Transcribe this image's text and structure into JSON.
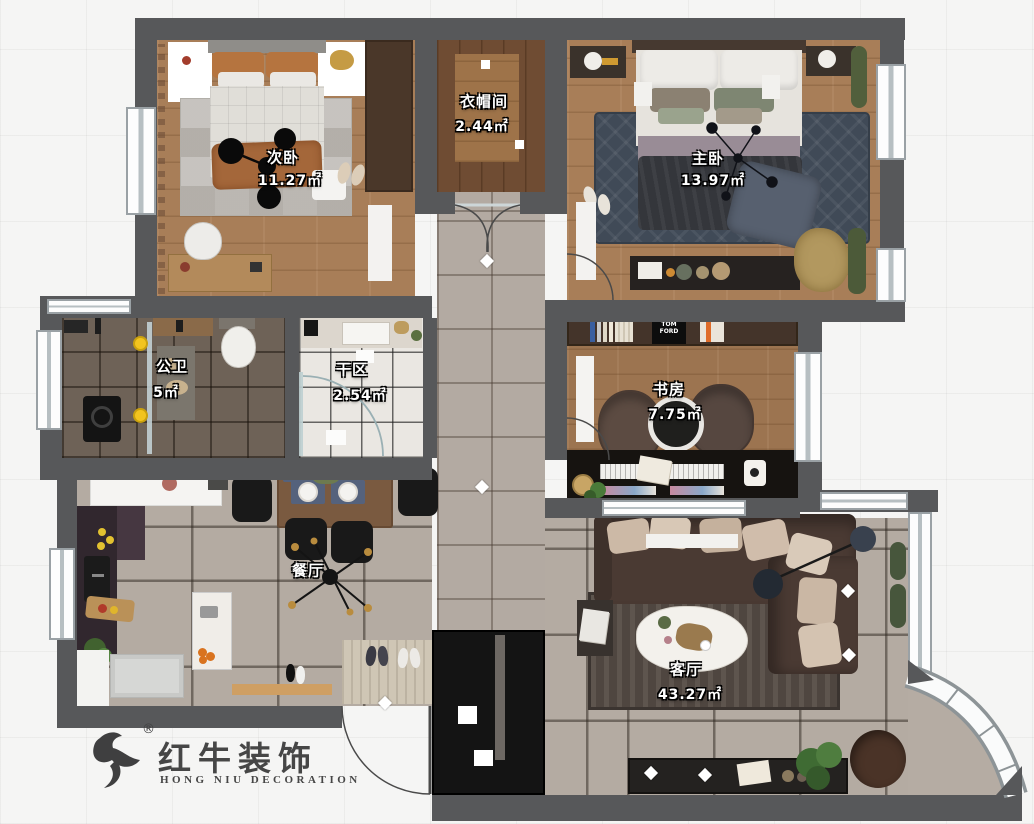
{
  "rooms": [
    {
      "key": "bed2",
      "label": "次卧",
      "area": "11.27㎡"
    },
    {
      "key": "closet",
      "label": "衣帽间",
      "area": "2.44㎡"
    },
    {
      "key": "master",
      "label": "主卧",
      "area": "13.97㎡"
    },
    {
      "key": "bath",
      "label": "公卫",
      "area": "5㎡"
    },
    {
      "key": "dry",
      "label": "干区",
      "area": "2.54㎡"
    },
    {
      "key": "study",
      "label": "书房",
      "area": "7.75㎡"
    },
    {
      "key": "dining",
      "label": "餐厅",
      "area": ""
    },
    {
      "key": "living",
      "label": "客厅",
      "area": "43.27㎡"
    }
  ],
  "logo": {
    "brand": "红牛装饰",
    "reg": "®",
    "subtitle": "HONG NIU DECORATION"
  },
  "decor": {
    "tom_ford": "TOM FORD"
  },
  "colors": {
    "wall": "#57585a",
    "wood_floor": "#a87e58",
    "wood_dark": "#6f4c33",
    "study_wood": "#9c7450",
    "tile_gray": "#b4aba2",
    "tile_bath": "#6e6257",
    "marble_white": "#eae7e2",
    "hall_marble": "#b3aaa2",
    "rug_master": "#404a57",
    "rug_living": "#4f4640",
    "sofa_brown": "#4a3a33",
    "accent_yellow": "#f2c41f",
    "cabinet_black": "#141414",
    "label_text": "#ffffff",
    "logo_text": "#464646",
    "window": "#ffffff"
  }
}
